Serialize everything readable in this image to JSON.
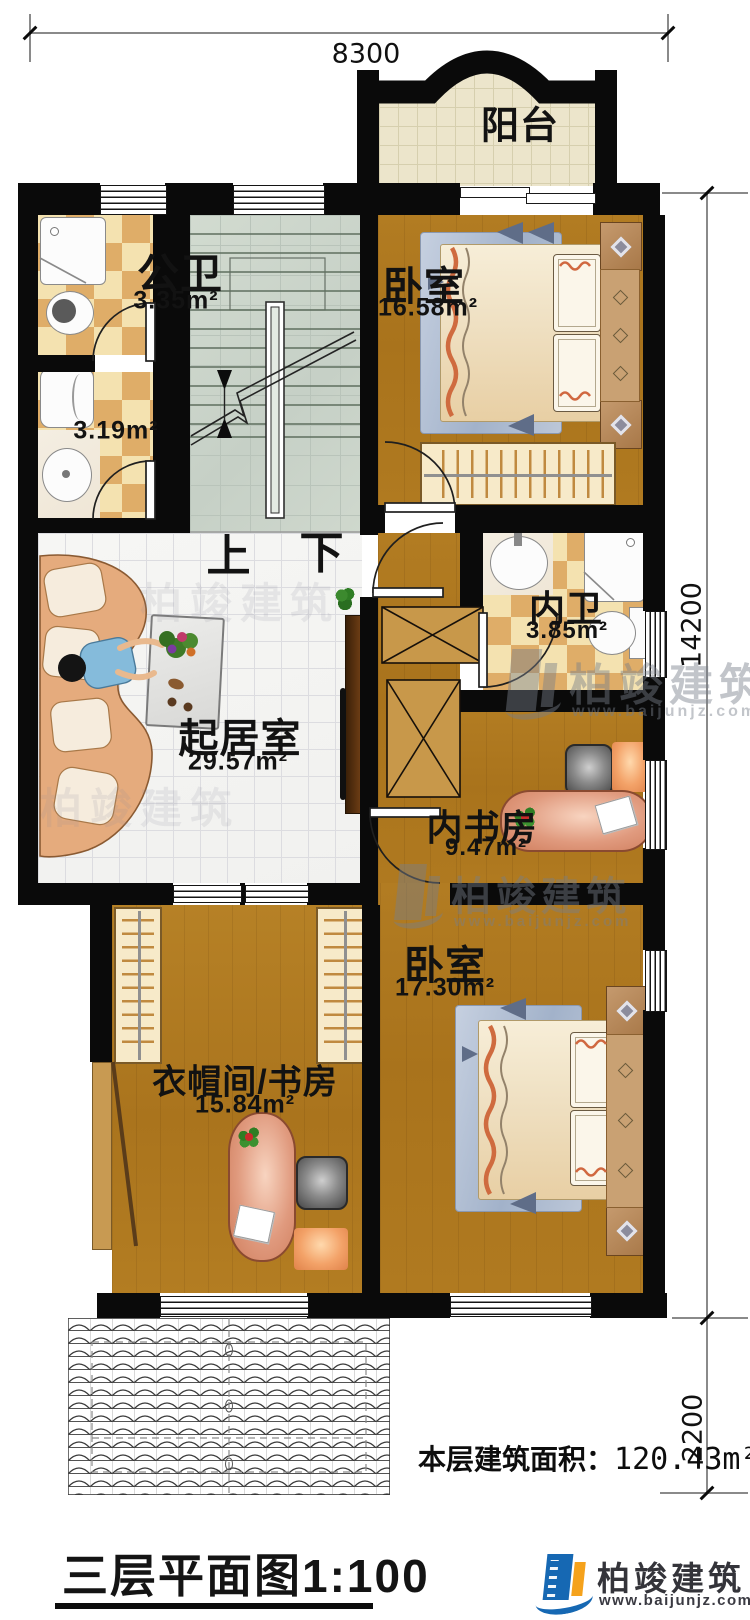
{
  "dims": {
    "top": "8300",
    "right_upper": "14200",
    "right_lower": "2200"
  },
  "rooms": {
    "balcony": {
      "name": "阳台"
    },
    "public_bath": {
      "name": "公卫",
      "area": "3.35m²"
    },
    "laundry": {
      "area": "3.19m²"
    },
    "bedroom_top": {
      "name": "卧室",
      "area": "16.58m²"
    },
    "inner_bath": {
      "name": "内卫",
      "area": "3.85m²"
    },
    "living": {
      "name": "起居室",
      "area": "29.57m²"
    },
    "inner_study": {
      "name": "内书房",
      "area": "9.47m²"
    },
    "bedroom_bottom": {
      "name": "卧室",
      "area": "17.30m²"
    },
    "cloak_study": {
      "name": "衣帽间/书房",
      "area": "15.84m²"
    }
  },
  "stairs": {
    "up": "上",
    "down": "下"
  },
  "notes": {
    "area_label": "本层建筑面积：",
    "area_value": "120.43m²"
  },
  "title": {
    "text": "三层平面图1:100"
  },
  "logo": {
    "name": "柏竣建筑",
    "site": "www.baijunjz.com"
  },
  "watermark": {
    "name": "柏竣建筑",
    "site": "www.baijunjz.com"
  },
  "colors": {
    "wall": "#0a0a0a",
    "wood": "#a9751f",
    "accent_blue": "#1668b3",
    "accent_orange": "#f5a21c"
  }
}
